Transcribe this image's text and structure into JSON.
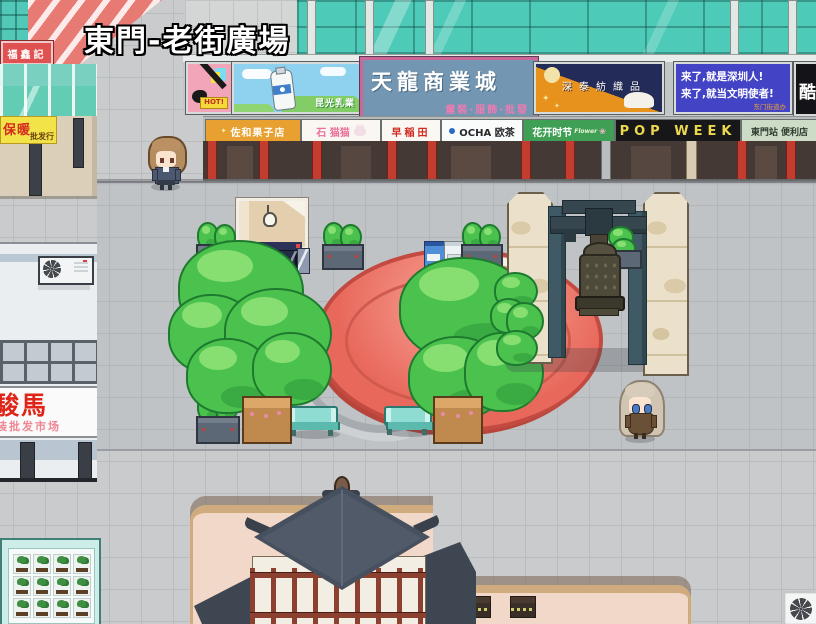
{
  "scene": {
    "title": "東門-老街廣場"
  },
  "colors": {
    "plaza_red": "#e8695c",
    "glass_teal": "#4ecab8",
    "courtyard_pink": "#f2d8c8",
    "slogan_blue": "#4343c6",
    "pop_week_yellow": "#ecd84e"
  },
  "banners": {
    "hot_tag": "HOT!",
    "milk_dairy": "昆光乳業",
    "mall_title": "天龍商業城",
    "mall_subtitle": "童裝·服飾·批發",
    "textile": "深泰紡織品",
    "slogan_line1": "来了,就是深圳人!",
    "slogan_line2": "来了,就当文明使者!",
    "slogan_credit": "东门街道办",
    "cool_sign": "酷"
  },
  "shops": {
    "sawa": "佐和果子店",
    "stone_cat": "石 猫猫",
    "waseda": "早稲田",
    "ocha": "OCHA 欧茶",
    "flower_season": "花开时节",
    "flower_script": "Flower",
    "pop_week": "POP WEEK",
    "convenience": "東門站 便利店"
  },
  "left_buildings": {
    "fuxinji": "福鑫記",
    "warm_main": "保暖",
    "warm_sub": "批发行",
    "horse_market_main": "駿馬",
    "horse_market_sub": "装批发市场"
  },
  "icons": {
    "sparkle": "✦",
    "flower": "❀",
    "map_wheel": "pinwheel-8"
  }
}
